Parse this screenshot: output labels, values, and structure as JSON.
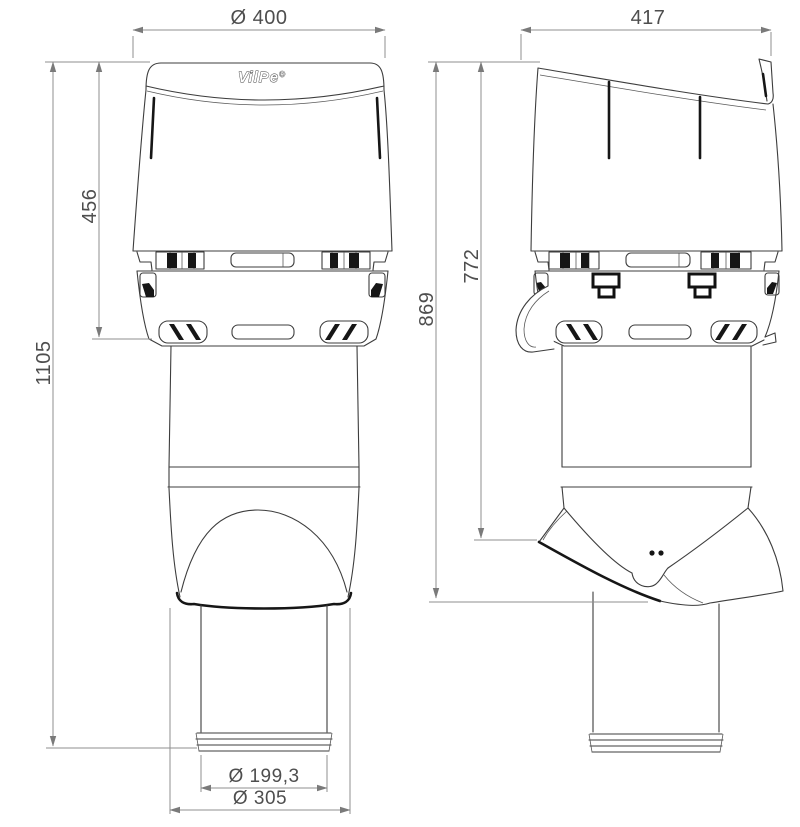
{
  "product": {
    "logo_text": "VilPe",
    "logo_mark": "®"
  },
  "dimensions": {
    "cap_diameter": "Ø 400",
    "side_width": "417",
    "cap_height": "456",
    "total_height": "1105",
    "side_total_height": "869",
    "side_upper_height": "772",
    "pipe_diameter": "Ø 199,3",
    "base_diameter": "Ø 305"
  },
  "colors": {
    "background": "#ffffff",
    "line": "#3d3d3d",
    "accent_black": "#161616",
    "dimension_line": "#8f8f8f",
    "dimension_text": "#4e4e4e"
  }
}
